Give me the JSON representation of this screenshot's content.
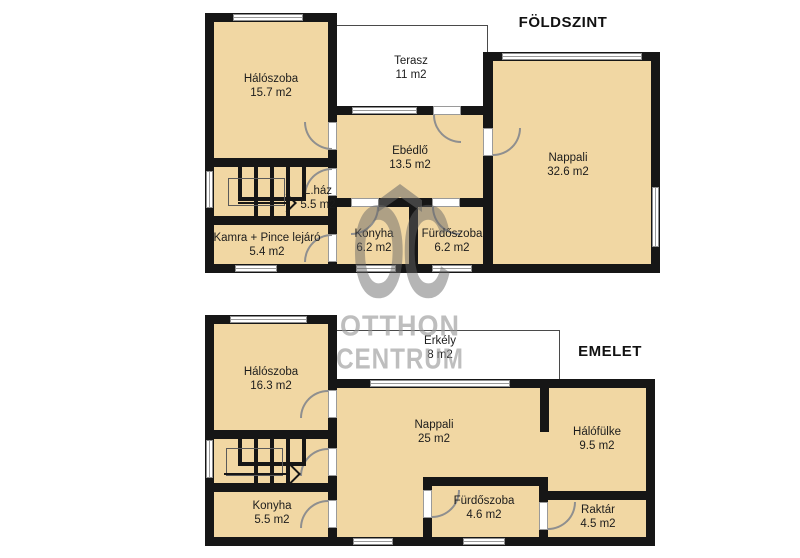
{
  "watermark": {
    "logo": "OC",
    "line1": "OTTHON",
    "line2": "CENTRUM"
  },
  "floors": {
    "ground": {
      "title": "FÖLDSZINT",
      "rooms": {
        "haloszoba": {
          "name": "Hálószoba",
          "area": "15.7 m2"
        },
        "terasz": {
          "name": "Terasz",
          "area": "11 m2"
        },
        "ebedlo": {
          "name": "Ebédlő",
          "area": "13.5 m2"
        },
        "nappali": {
          "name": "Nappali",
          "area": "32.6 m2"
        },
        "lhaz": {
          "name": "L.ház",
          "area": "5.5 m2"
        },
        "kamra": {
          "name": "Kamra + Pince lejáró",
          "area": "5.4 m2"
        },
        "konyha": {
          "name": "Konyha",
          "area": "6.2 m2"
        },
        "furdoszoba": {
          "name": "Fürdőszoba",
          "area": "6.2 m2"
        }
      }
    },
    "upper": {
      "title": "EMELET",
      "rooms": {
        "haloszoba": {
          "name": "Hálószoba",
          "area": "16.3 m2"
        },
        "erkely": {
          "name": "Erkély",
          "area": "8 m2"
        },
        "nappali": {
          "name": "Nappali",
          "area": "25 m2"
        },
        "halofulke": {
          "name": "Hálófülke",
          "area": "9.5 m2"
        },
        "konyha": {
          "name": "Konyha",
          "area": "5.5 m2"
        },
        "furdoszoba": {
          "name": "Fürdőszoba",
          "area": "4.6 m2"
        },
        "raktar": {
          "name": "Raktár",
          "area": "4.5 m2"
        }
      }
    }
  },
  "colors": {
    "room_fill": "#f1d7a3",
    "wall": "#161616",
    "window_frame": "#8f8f8f",
    "watermark_gray": "#969696",
    "background": "#ffffff"
  }
}
